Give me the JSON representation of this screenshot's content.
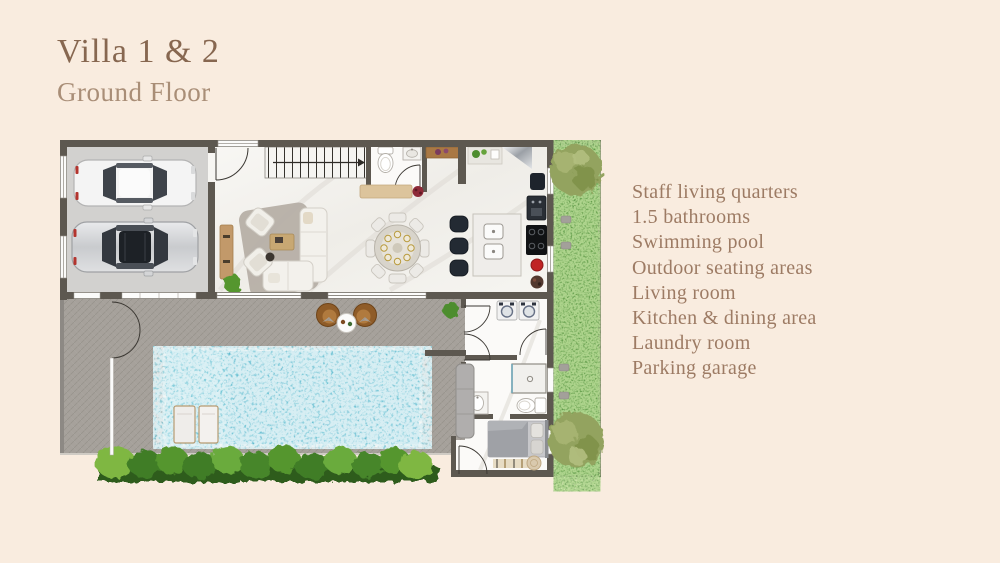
{
  "header": {
    "title": "Villa 1 & 2",
    "subtitle": "Ground Floor"
  },
  "features": {
    "items": [
      "Staff living quarters",
      "1.5 bathrooms",
      "Swimming pool",
      "Outdoor seating areas",
      "Living room",
      "Kitchen & dining area",
      "Laundry room",
      "Parking garage"
    ]
  },
  "theme": {
    "bg": "#f9ecdf",
    "title-color": "#876750",
    "subtitle-color": "#a98e77",
    "list-color": "#9d7b64",
    "wall": "#5d5850",
    "marble": "#f5f3ef",
    "garage-floor": "#d2d1cf",
    "deck": "#a6a19b",
    "pool-water": "#62b7cd",
    "hedge": "#4b8b2f",
    "wood": "#c2996a",
    "chair-brown": "#8f5c28"
  }
}
